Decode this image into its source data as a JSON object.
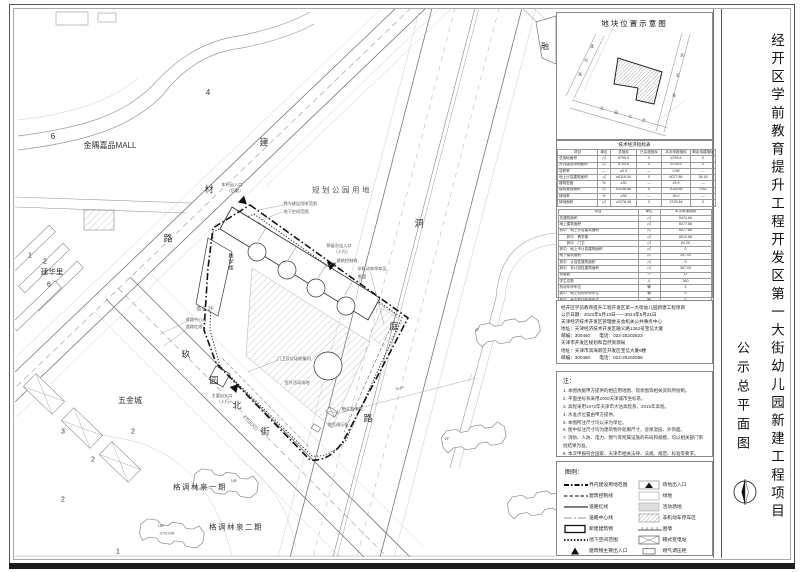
{
  "page": {
    "title_vertical": "经开区学前教育提升工程开发区第一大街幼儿园新建工程项目",
    "subtitle_vertical": "公示总平面图"
  },
  "inset": {
    "title": "地块位置示意图",
    "chars": [
      "建",
      "材",
      "路",
      "洞",
      "庭",
      "路",
      "玖",
      "园",
      "北",
      "街"
    ]
  },
  "table": {
    "title": "技术经济指标表",
    "upper": {
      "headers": [
        "项目",
        "单位",
        "总指标",
        "已实施指标",
        "本次申报指标",
        "剩余待建指标"
      ],
      "rows": [
        [
          "总用地面积",
          "㎡",
          "6795.6",
          "0",
          "6795.6",
          "0"
        ],
        [
          "界内建设用地面积",
          "㎡",
          "6795.6",
          "0",
          "6795.6",
          "0"
        ],
        [
          "容积率",
          "—",
          "≤0.9",
          "—",
          "0.89",
          "—"
        ],
        [
          "地上计容建筑面积",
          "㎡",
          "≤6116.04",
          "0",
          "6077.86",
          "38.18"
        ],
        [
          "建筑密度",
          "%",
          "≤30",
          "—",
          "29.9",
          "—"
        ],
        [
          "建筑基底面积",
          "㎡",
          "≤2038.68",
          "0",
          "2028.86",
          "9.82"
        ],
        [
          "绿地率",
          "%",
          "≥35",
          "—",
          "35.0",
          "—"
        ],
        [
          "绿地面积",
          "㎡",
          "≥2378.46",
          "0",
          "2378.46",
          "0"
        ]
      ]
    },
    "lower": {
      "headers": [
        "项目",
        "单位",
        "本次申报指标"
      ],
      "rows": [
        [
          "总建筑面积",
          "㎡",
          "6474.86"
        ],
        [
          "地上建筑面积",
          "㎡",
          "6077.86"
        ],
        [
          "其中　地上计容建筑面积",
          "㎡",
          "6077.86"
        ],
        [
          "　　其中　教学楼",
          "㎡",
          "6013.66"
        ],
        [
          "　　其中　门卫",
          "㎡",
          "64.20"
        ],
        [
          "其中　地上不计容建筑面积",
          "㎡",
          "0"
        ],
        [
          "地下建筑面积",
          "㎡",
          "397.00"
        ],
        [
          "其中　计容性建筑面积",
          "㎡",
          "0"
        ],
        [
          "其中　非计容性建筑面积",
          "㎡",
          "397.00"
        ],
        [
          "班级数",
          "个",
          "12"
        ],
        [
          "学生总数",
          "人",
          "360"
        ],
        [
          "机动车停车位",
          "辆",
          "5"
        ],
        [
          "其中　地上机动车停车位",
          "辆",
          "5"
        ],
        [
          "其中　地下机动车停车位",
          "辆",
          "0"
        ],
        [
          "非机动车停车位",
          "辆",
          "40"
        ],
        [
          "其中　地上非机动车停车位",
          "辆",
          "40"
        ],
        [
          "其中　地下非机动车停车位",
          "辆",
          "0"
        ]
      ]
    }
  },
  "info": {
    "lines": [
      "经开区学前教育提升工程开发区第一大街幼儿园新建工程项目",
      "公示日期：2024年5月13日——2024年5月21日",
      "天津经济技术开发区管理委员会机关公共事务中心",
      "地址：天津经济技术开发区融义路1262号宝信大厦",
      "邮编：300450　　电话：022-25202823",
      "天津市开发区规划和自然资源局",
      "地址：天津市滨海新区开发区宝信大厦6楼",
      "邮编：300450　　电话：022-25202068"
    ]
  },
  "notes": {
    "title": "注：",
    "items": [
      "1. 本图依据甲方提供的相应用地图、现状图等相关资料所绘制。",
      "2. 平面坐标系采用2000天津城市坐标系。",
      "3. 高程采用1972年天津市大沽高程系，2015年高程。",
      "4. 水准点位置由甲方提供。",
      "5. 本图所注尺寸均以米为单位。",
      "6. 图中标注尺寸均为建筑物外轮廓尺寸，含保温层、外饰面。",
      "7. 消防、人防、电力、燃气等附属设施的布局和规模，均以相关部门审批结果为准。",
      "8. 本次申报符合国家、天津市相关法律、法规、规范、标准等要求。"
    ]
  },
  "legend": {
    "title": "图例：",
    "left": [
      "界内建设用地范围",
      "建筑控制线",
      "道路红线",
      "道路中心线",
      "新建建筑物",
      "地下空间范围",
      "建筑物主要出入口"
    ],
    "right": [
      "场地出入口",
      "绿地",
      "活动场地",
      "非机动车停车区",
      "围墙",
      "箱式变电站",
      "燃气调压柜"
    ]
  },
  "map": {
    "labels": [
      "金隅嘉品MALL",
      "规划公园用地",
      "建",
      "材",
      "路",
      "洞",
      "庭",
      "路",
      "玖",
      "园",
      "北",
      "街",
      "建华里",
      "五金城",
      "格调林泉一期",
      "格调林泉二期",
      "融",
      "4",
      "6",
      "1",
      "2",
      "6",
      "3",
      "2",
      "2",
      "2",
      "1",
      "18F",
      "18F",
      "H=53.60M",
      "2F",
      "2F",
      "商业 2F",
      "车行出入口",
      "（后勤）",
      "预留次出入口",
      "（人行）",
      "主要出入口",
      "（人行）",
      "人行出入口",
      "界内建设用地范围",
      "地下空间范围",
      "建筑控制线",
      "非机动车停车区",
      "围墙",
      "教学楼",
      "门卫及垃圾收集间",
      "室外活动场地",
      "箱式变电站",
      "燃气调压柜",
      "道路中心线",
      "道路红线",
      "35.00"
    ]
  }
}
